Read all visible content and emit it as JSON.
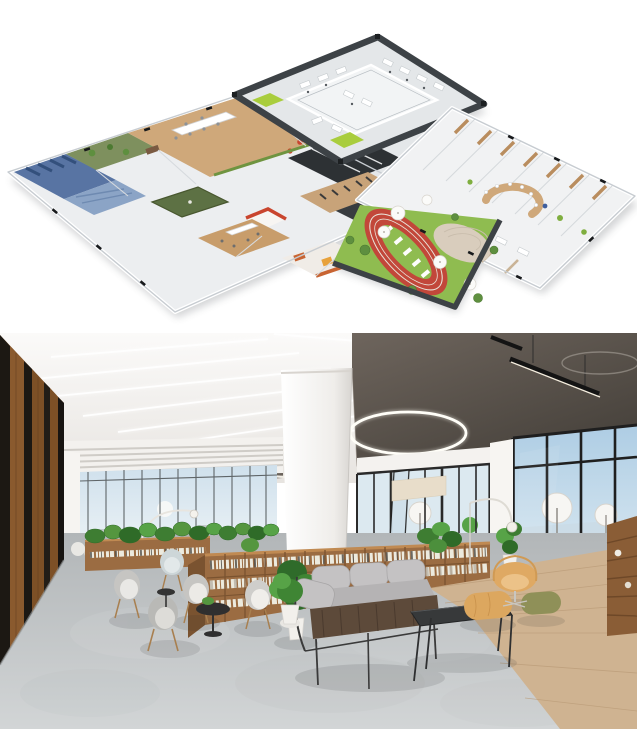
{
  "page": {
    "width": 637,
    "height": 729,
    "background": "#ffffff",
    "title": "Smart office concept — isometric floor plan and lounge interior render"
  },
  "top_panel": {
    "alt": "Isometric 3D floor plan of an office campus: three connected wings with open offices, meeting rooms, library, gym and cafeteria, plus an outdoor terrace with a red running track on a green lawn and umbrella tables",
    "palette": {
      "wall": "#f1f2f3",
      "floor": "#eceef0",
      "floor_shaded": "#e4e7e9",
      "rim": "#3d4246",
      "wall_line": "#c7ccd1",
      "wood": "#cfa87a",
      "wood_dark": "#b98d5e",
      "wood_gym": "#c8a379",
      "lawn": "#8fbc50",
      "track": "#c2473a",
      "track_lane": "#e9e3d9",
      "lime": "#a9cd3d",
      "moss": "#7e905e",
      "blue": "#5874a3",
      "blue_light": "#8ba4c6",
      "dark_room": "#2d3134",
      "dark_room_alt": "#383c40",
      "stage_green": "#5d7144",
      "teal": "#23c3a0",
      "orange": "#c86432",
      "amber": "#e8a23c",
      "red": "#c9452e",
      "patio": "#d9cdbd",
      "tree": "#5e8f3f",
      "umbrella": "#fbfbf9"
    },
    "areas": [
      "open office block",
      "innovation lab",
      "library lounge",
      "meeting room cluster",
      "gym",
      "cafeteria",
      "retail corner",
      "dorm wing",
      "amphitheater counter",
      "outdoor terrace",
      "running track",
      "patio"
    ]
  },
  "bottom_panel": {
    "alt": "Photorealistic render of an office library lounge: gray lounge chairs and a sofa around black coffee tables, low wooden bookshelves topped with plants, a white column, concrete and wood flooring, dark wood slat wall, ring and linear pendant lights, and floor-to-ceiling windows onto a sea-view terrace with umbrellas",
    "palette": {
      "ceiling": "#f3f1ee",
      "ceiling_dark": "#5d554e",
      "wall": "#f6f4f1",
      "wood_wall": "#7d5026",
      "wood_wall_dark": "#1c1813",
      "sky": "#c7dbe9",
      "sky_light": "#eaf1f5",
      "sea": "#cadbe5",
      "mullion": "#1f1f1f",
      "shelf": "#9b6c42",
      "shelf_dark": "#7a5330",
      "shelf_edge": "#c08a52",
      "books_light": "#eceade",
      "books_dark": "#55524c",
      "plant": "#3e7d32",
      "plant_light": "#57a347",
      "floor_concrete": "#c6c9cb",
      "floor_wood": "#cfb391",
      "sofa": "#b5b3b4",
      "cushion": "#c4c2c3",
      "sofa_base": "#5d4a3a",
      "chair": "#c6c5c2",
      "table_black": "#37393a",
      "ottoman": "#dca75f",
      "pouf": "#8f9058",
      "swan": "#dfa963",
      "deck": "#cfb48e",
      "grass": "#7fa859",
      "frame": "#2a2a2a"
    },
    "objects": [
      "linear ceiling lights",
      "ring pendant light",
      "suspended linear pendants",
      "wood slat wall",
      "white column",
      "bookshelves with plants",
      "lounge chairs",
      "coffee tables",
      "three-seat sofa",
      "ottoman",
      "pouf",
      "swan chair",
      "arc floor lamps",
      "potted monstera",
      "terrace umbrellas",
      "bar stools"
    ]
  }
}
